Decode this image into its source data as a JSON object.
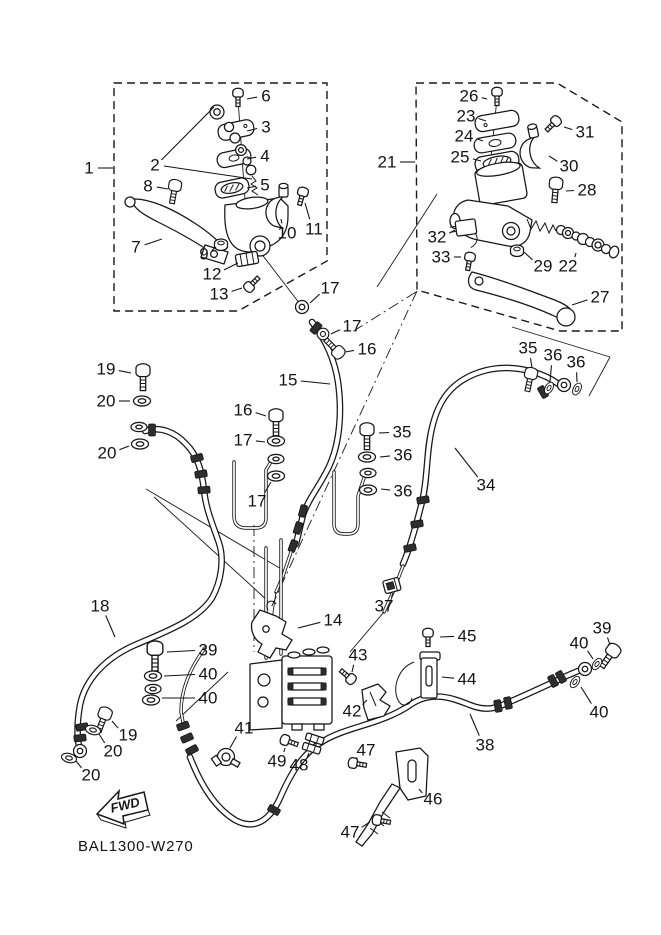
{
  "diagram": {
    "code": "BAL1300-W270",
    "fwd": "FWD",
    "line_color": "#161616",
    "background": "#ffffff"
  },
  "labels": [
    {
      "t": "1",
      "x": 89,
      "y": 168,
      "to": [
        [
          113,
          168
        ]
      ]
    },
    {
      "t": "2",
      "x": 155,
      "y": 165,
      "to": [
        [
          214,
          107
        ],
        [
          252,
          179
        ]
      ]
    },
    {
      "t": "6",
      "x": 266,
      "y": 96,
      "to": [
        [
          247,
          99
        ]
      ]
    },
    {
      "t": "3",
      "x": 266,
      "y": 127,
      "to": [
        [
          247,
          131
        ]
      ]
    },
    {
      "t": "4",
      "x": 265,
      "y": 156,
      "to": [
        [
          247,
          159
        ]
      ]
    },
    {
      "t": "5",
      "x": 265,
      "y": 185,
      "to": [
        [
          247,
          188
        ]
      ]
    },
    {
      "t": "8",
      "x": 148,
      "y": 186,
      "to": [
        [
          168,
          189
        ]
      ]
    },
    {
      "t": "7",
      "x": 136,
      "y": 247,
      "to": [
        [
          162,
          239
        ]
      ]
    },
    {
      "t": "9",
      "x": 204,
      "y": 254,
      "to": [
        [
          216,
          247
        ]
      ]
    },
    {
      "t": "10",
      "x": 287,
      "y": 233,
      "to": [
        [
          281,
          219
        ]
      ]
    },
    {
      "t": "11",
      "x": 314,
      "y": 229,
      "to": [
        [
          305,
          203
        ]
      ]
    },
    {
      "t": "12",
      "x": 212,
      "y": 274,
      "to": [
        [
          238,
          263
        ]
      ]
    },
    {
      "t": "13",
      "x": 219,
      "y": 294,
      "to": [
        [
          242,
          288
        ]
      ]
    },
    {
      "t": "17",
      "x": 330,
      "y": 288,
      "to": [
        [
          310,
          303
        ]
      ]
    },
    {
      "t": "17",
      "x": 352,
      "y": 326,
      "to": [
        [
          331,
          334
        ]
      ]
    },
    {
      "t": "16",
      "x": 367,
      "y": 349,
      "to": [
        [
          345,
          352
        ]
      ]
    },
    {
      "t": "15",
      "x": 288,
      "y": 380,
      "to": [
        [
          330,
          384
        ]
      ]
    },
    {
      "t": "21",
      "x": 387,
      "y": 162,
      "to": [
        [
          415,
          162
        ]
      ]
    },
    {
      "t": "26",
      "x": 469,
      "y": 96,
      "to": [
        [
          487,
          99
        ]
      ]
    },
    {
      "t": "23",
      "x": 466,
      "y": 116,
      "to": [
        [
          486,
          121
        ]
      ]
    },
    {
      "t": "24",
      "x": 464,
      "y": 136,
      "to": [
        [
          483,
          141
        ]
      ]
    },
    {
      "t": "25",
      "x": 460,
      "y": 157,
      "to": [
        [
          481,
          161
        ]
      ]
    },
    {
      "t": "31",
      "x": 585,
      "y": 132,
      "to": [
        [
          564,
          127
        ]
      ]
    },
    {
      "t": "30",
      "x": 569,
      "y": 166,
      "to": [
        [
          549,
          156
        ]
      ]
    },
    {
      "t": "28",
      "x": 587,
      "y": 190,
      "to": [
        [
          566,
          191
        ]
      ]
    },
    {
      "t": "29",
      "x": 543,
      "y": 266,
      "to": [
        [
          524,
          252
        ]
      ]
    },
    {
      "t": "22",
      "x": 568,
      "y": 266,
      "to": [
        [
          576,
          253
        ]
      ]
    },
    {
      "t": "32",
      "x": 437,
      "y": 237,
      "to": [
        [
          455,
          230
        ]
      ]
    },
    {
      "t": "33",
      "x": 441,
      "y": 257,
      "to": [
        [
          461,
          257
        ]
      ]
    },
    {
      "t": "27",
      "x": 600,
      "y": 297,
      "to": [
        [
          572,
          305
        ]
      ]
    },
    {
      "t": "19",
      "x": 106,
      "y": 369,
      "to": [
        [
          131,
          373
        ]
      ]
    },
    {
      "t": "20",
      "x": 106,
      "y": 401,
      "to": [
        [
          130,
          401
        ]
      ]
    },
    {
      "t": "20",
      "x": 107,
      "y": 453,
      "to": [
        [
          129,
          446
        ]
      ]
    },
    {
      "t": "16",
      "x": 243,
      "y": 410,
      "to": [
        [
          266,
          416
        ]
      ]
    },
    {
      "t": "17",
      "x": 243,
      "y": 440,
      "to": [
        [
          265,
          442
        ]
      ]
    },
    {
      "t": "17",
      "x": 257,
      "y": 501,
      "to": [
        [
          271,
          482
        ]
      ]
    },
    {
      "t": "35",
      "x": 402,
      "y": 432,
      "to": [
        [
          379,
          433
        ]
      ]
    },
    {
      "t": "36",
      "x": 403,
      "y": 455,
      "to": [
        [
          380,
          457
        ]
      ]
    },
    {
      "t": "36",
      "x": 403,
      "y": 491,
      "to": [
        [
          381,
          489
        ]
      ]
    },
    {
      "t": "35",
      "x": 528,
      "y": 348,
      "to": [
        [
          532,
          368
        ]
      ]
    },
    {
      "t": "36",
      "x": 553,
      "y": 355,
      "to": [
        [
          550,
          381
        ]
      ]
    },
    {
      "t": "36",
      "x": 576,
      "y": 362,
      "to": [
        [
          577,
          382
        ]
      ]
    },
    {
      "t": "34",
      "x": 486,
      "y": 485,
      "to": [
        [
          455,
          448
        ]
      ]
    },
    {
      "t": "37",
      "x": 384,
      "y": 606,
      "to": [
        [
          393,
          593
        ]
      ]
    },
    {
      "t": "18",
      "x": 100,
      "y": 606,
      "to": [
        [
          115,
          637
        ]
      ]
    },
    {
      "t": "14",
      "x": 333,
      "y": 620,
      "to": [
        [
          298,
          628
        ]
      ]
    },
    {
      "t": "39",
      "x": 208,
      "y": 650,
      "to": [
        [
          167,
          652
        ]
      ]
    },
    {
      "t": "40",
      "x": 208,
      "y": 674,
      "to": [
        [
          164,
          676
        ]
      ]
    },
    {
      "t": "40",
      "x": 208,
      "y": 698,
      "to": [
        [
          162,
          698
        ]
      ]
    },
    {
      "t": "19",
      "x": 128,
      "y": 735,
      "to": [
        [
          112,
          721
        ]
      ]
    },
    {
      "t": "20",
      "x": 113,
      "y": 751,
      "to": [
        [
          99,
          734
        ]
      ]
    },
    {
      "t": "20",
      "x": 91,
      "y": 775,
      "to": [
        [
          76,
          761
        ]
      ]
    },
    {
      "t": "41",
      "x": 244,
      "y": 728,
      "to": [
        [
          230,
          748
        ]
      ]
    },
    {
      "t": "43",
      "x": 358,
      "y": 655,
      "to": [
        [
          352,
          672
        ]
      ]
    },
    {
      "t": "42",
      "x": 352,
      "y": 711,
      "to": [
        [
          367,
          700
        ]
      ]
    },
    {
      "t": "45",
      "x": 467,
      "y": 636,
      "to": [
        [
          440,
          637
        ]
      ]
    },
    {
      "t": "44",
      "x": 467,
      "y": 679,
      "to": [
        [
          442,
          677
        ]
      ]
    },
    {
      "t": "46",
      "x": 433,
      "y": 799,
      "to": [
        [
          419,
          789
        ]
      ]
    },
    {
      "t": "47",
      "x": 366,
      "y": 750,
      "to": [
        [
          357,
          759
        ]
      ]
    },
    {
      "t": "47",
      "x": 350,
      "y": 832,
      "to": [
        [
          370,
          822
        ]
      ]
    },
    {
      "t": "48",
      "x": 299,
      "y": 765,
      "to": [
        [
          309,
          753
        ]
      ]
    },
    {
      "t": "49",
      "x": 277,
      "y": 761,
      "to": [
        [
          285,
          748
        ]
      ]
    },
    {
      "t": "38",
      "x": 485,
      "y": 745,
      "to": [
        [
          470,
          714
        ]
      ]
    },
    {
      "t": "39",
      "x": 602,
      "y": 628,
      "to": [
        [
          610,
          645
        ]
      ]
    },
    {
      "t": "40",
      "x": 579,
      "y": 643,
      "to": [
        [
          593,
          659
        ]
      ]
    },
    {
      "t": "40",
      "x": 599,
      "y": 712,
      "to": [
        [
          581,
          687
        ]
      ]
    }
  ]
}
